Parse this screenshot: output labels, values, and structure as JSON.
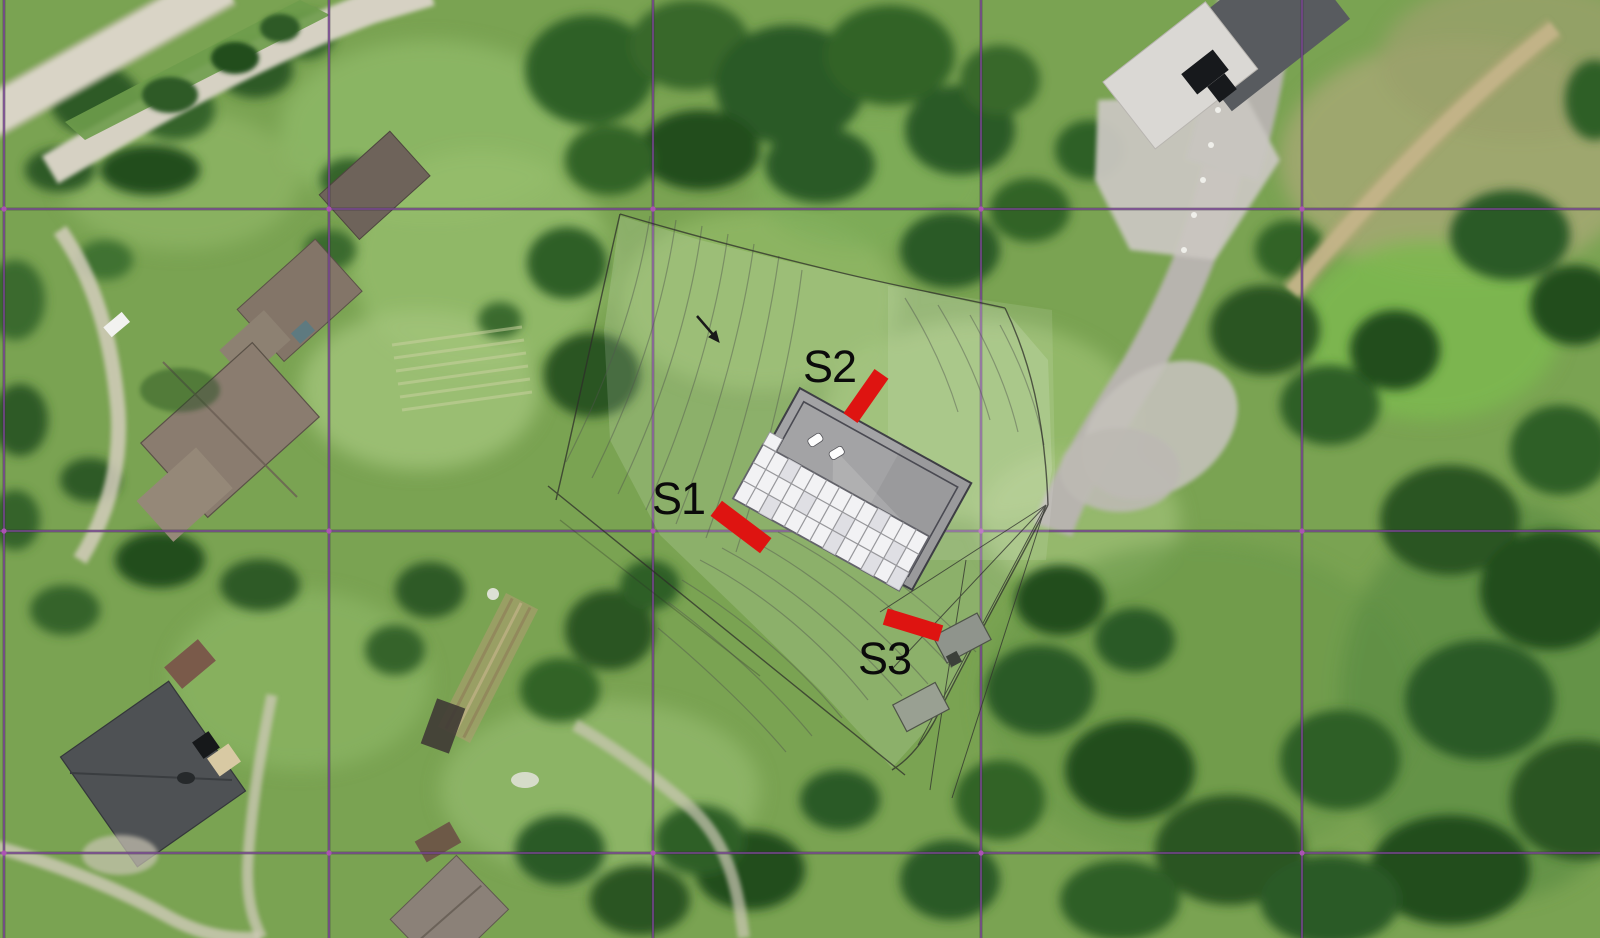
{
  "meta": {
    "description": "Aerial orthophoto with architectural site plan overlay, survey grid and three sampling points",
    "width_px": 1600,
    "height_px": 938
  },
  "site_plan": {
    "markers": [
      {
        "label": "S1",
        "text_x": 652,
        "text_y": 514,
        "bar": {
          "cx": 741,
          "cy": 527,
          "w": 62,
          "h": 19,
          "angle": 37
        }
      },
      {
        "label": "S2",
        "text_x": 803,
        "text_y": 382,
        "bar": {
          "cx": 866,
          "cy": 396,
          "w": 54,
          "h": 17,
          "angle": -55
        }
      },
      {
        "label": "S3",
        "text_x": 858,
        "text_y": 674,
        "bar": {
          "cx": 913,
          "cy": 625,
          "w": 58,
          "h": 17,
          "angle": 17
        }
      }
    ],
    "marker_color": "#de1411",
    "label_color": "#0b0b0b",
    "label_font_px": 45,
    "building": {
      "cx": 856,
      "cy": 489,
      "length": 196,
      "width": 122,
      "rotation_deg": 29,
      "roof_color": "#a3a3a5",
      "panel_rows": 3,
      "panel_cols": 13,
      "panel_band": {
        "x": -103,
        "y": 6,
        "w": 190,
        "h": 62
      },
      "panel_color": "#f2f2f4",
      "panel_line_color": "#97979b"
    }
  },
  "survey_grid": {
    "color": "#7a4793",
    "intersection_color": "#b455b8",
    "vertical_x": [
      4,
      329,
      653,
      981,
      1302
    ],
    "horizontal_y": [
      209,
      531,
      853
    ]
  }
}
